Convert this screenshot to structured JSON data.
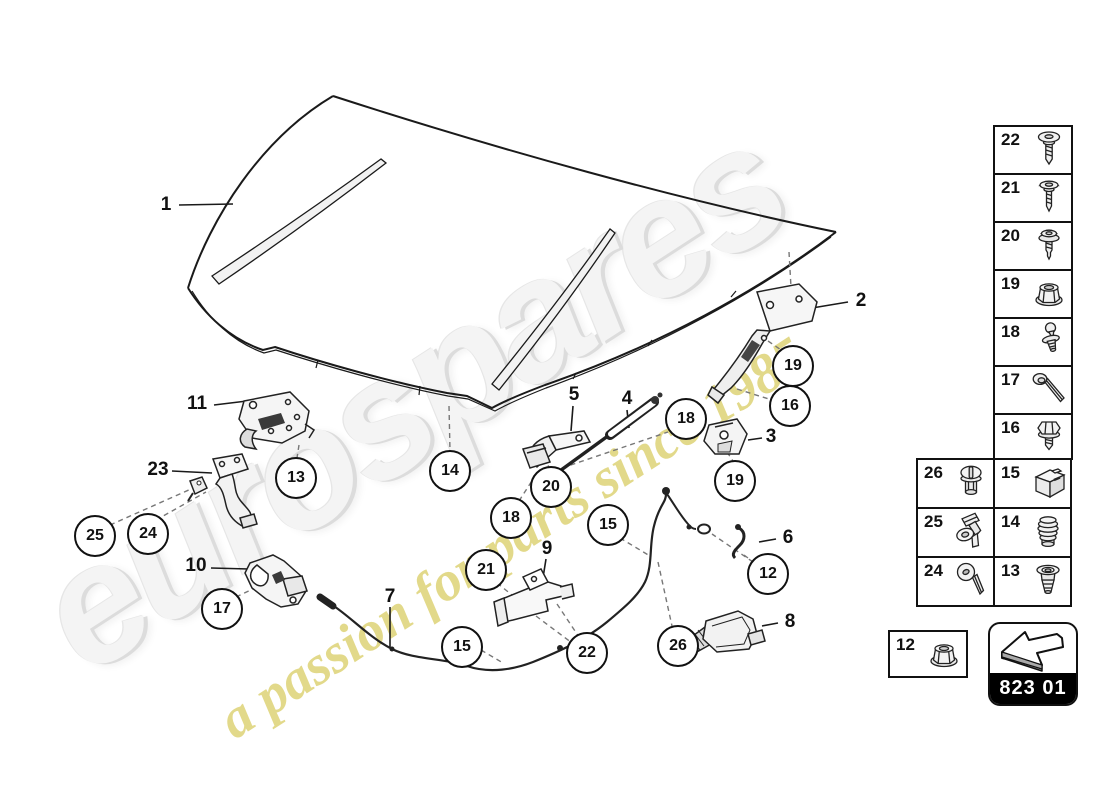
{
  "watermark": {
    "brand": "eurospares",
    "tagline": "a passion for parts since 1985",
    "brand_color": "#f4f4f4",
    "tagline_color": "#dcd06e"
  },
  "diagram": {
    "description": "Bonnet parts diagram with callouts",
    "plain_labels": [
      "1",
      "2",
      "3",
      "4",
      "5",
      "6",
      "7",
      "8",
      "9",
      "10",
      "11",
      "23"
    ],
    "circled_labels": [
      "12",
      "13",
      "14",
      "15",
      "15",
      "16",
      "17",
      "18",
      "18",
      "19",
      "19",
      "20",
      "21",
      "22",
      "24",
      "25",
      "26"
    ],
    "line_color": "#1a1a1a",
    "dash_color": "#777777"
  },
  "sidebar": {
    "column_cells": [
      {
        "number": "22",
        "icon": "pan-head-screw-icon"
      },
      {
        "number": "21",
        "icon": "oval-head-screw-icon"
      },
      {
        "number": "20",
        "icon": "washer-screw-icon"
      },
      {
        "number": "19",
        "icon": "flange-nut-icon"
      },
      {
        "number": "18",
        "icon": "ball-stud-icon"
      },
      {
        "number": "17",
        "icon": "long-bolt-icon"
      },
      {
        "number": "16",
        "icon": "hex-flange-bolt-icon"
      }
    ],
    "grid_cells": [
      {
        "number": "26",
        "icon": "plastic-nut-icon"
      },
      {
        "number": "15",
        "icon": "clip-block-icon"
      },
      {
        "number": "25",
        "icon": "retaining-clip-icon"
      },
      {
        "number": "14",
        "icon": "rubber-buffer-icon"
      },
      {
        "number": "24",
        "icon": "torx-screw-icon"
      },
      {
        "number": "13",
        "icon": "expanding-grommet-icon"
      }
    ],
    "nut_box": {
      "number": "12",
      "icon": "flange-nut-icon"
    },
    "badge": {
      "code": "823 01",
      "icon": "direction-arrow-icon"
    }
  }
}
